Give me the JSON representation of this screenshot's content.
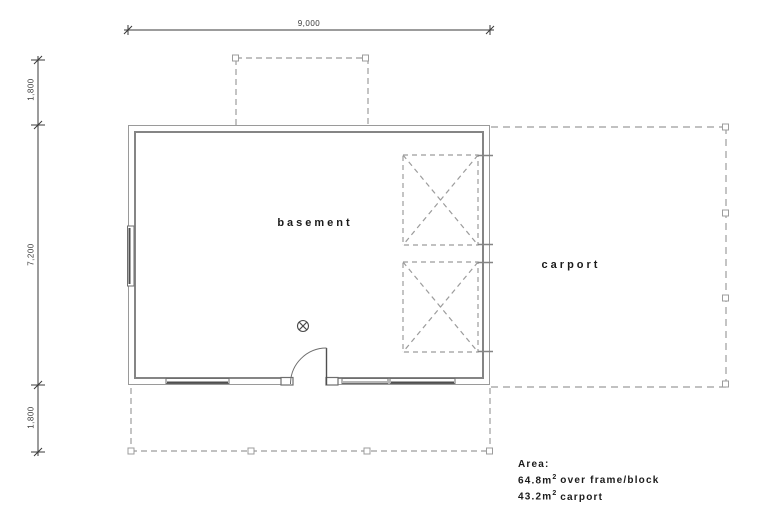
{
  "drawing": {
    "dimensions": {
      "width_top": "9,000",
      "left_upper": "1,800",
      "left_middle": "7,200",
      "left_lower": "1,800"
    },
    "rooms": {
      "basement": "basement",
      "carport": "carport"
    },
    "area_note": {
      "heading": "Area:",
      "lines": [
        {
          "pre": "64.8m",
          "sup": "2",
          "post": "over frame/block"
        },
        {
          "pre": "43.2m",
          "sup": "2",
          "post": "carport"
        }
      ]
    }
  },
  "symbols": {
    "door": "door-swing",
    "drain": "circle-x-symbol",
    "roof_openings": "dashed-cross-box",
    "posts": "post-square"
  },
  "colors": {
    "wall": "#9a9a9a",
    "wall_inner": "#858585",
    "window_line": "#4f4f4f",
    "frame_line": "#6e6e6e",
    "dashed": "#9c9c9c",
    "dim": "#3a3a3a",
    "text": "#1b1b1b"
  }
}
